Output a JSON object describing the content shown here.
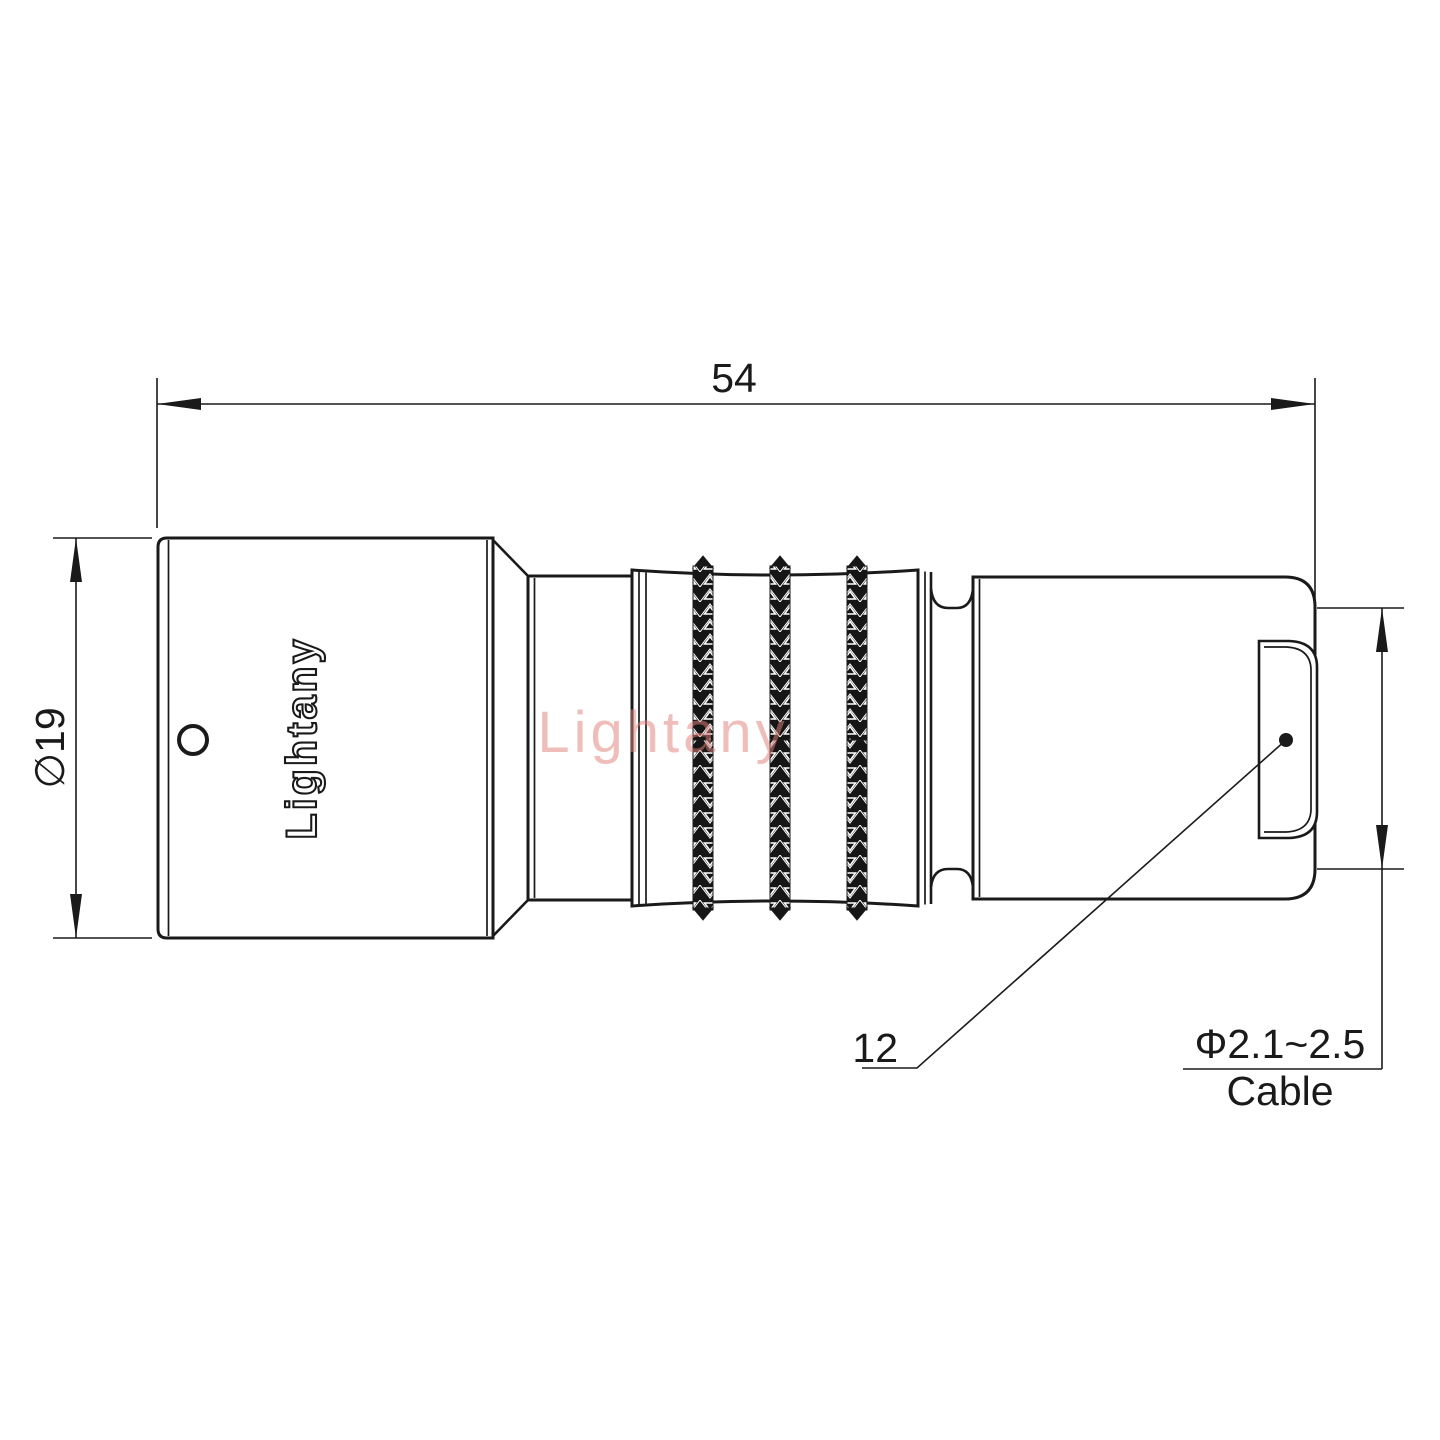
{
  "colors": {
    "line-color": "#1a1a1a",
    "watermark-color": "#e2827a",
    "knurl-fill": "#161616",
    "bg": "#ffffff"
  },
  "drawing": {
    "type": "technical-drawing",
    "subject": "push-pull circular cable connector, side view",
    "dimensions": {
      "overall_length": "54",
      "body_diameter": "∅19",
      "rear_face": "12",
      "cable_diameter_range": "Φ2.1~2.5",
      "cable_label": "Cable"
    },
    "branding": {
      "body_logo": "Lightany",
      "watermark": "Lightany"
    }
  }
}
